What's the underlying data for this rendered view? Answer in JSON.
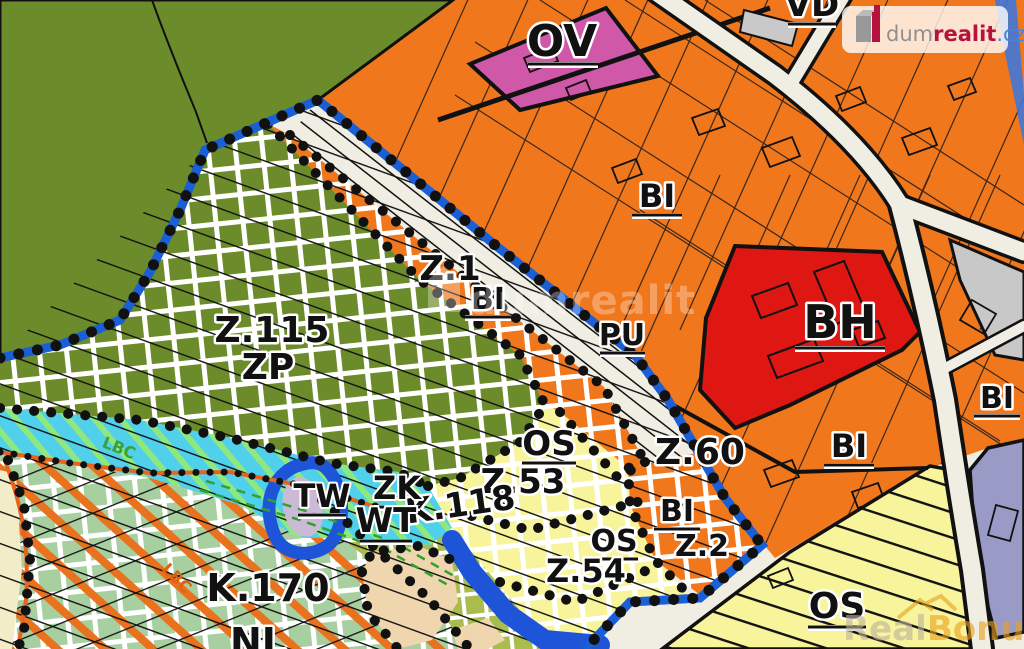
{
  "map": {
    "labels": {
      "ov": "OV",
      "vd": "VD",
      "bi": "BI",
      "bh": "BH",
      "pu": "PU",
      "z1": "Z.1",
      "z115": "Z.115",
      "zp": "ZP",
      "z60": "Z.60",
      "os": "OS",
      "z53": "Z.53",
      "z54": "Z.54",
      "k118": "K.118",
      "z2": "Z.2",
      "tw": "TW",
      "zk": "ZK",
      "wt": "WT",
      "k170": "K.170",
      "nl": "NL",
      "lbc": "LBC"
    },
    "colors": {
      "residential_bi": "#F1771D",
      "apartments_bh": "#DF1712",
      "civic_ov": "#CF58A8",
      "greenery_zp": "#6C8B2A",
      "landscape_green": "#A8CFA0",
      "olive_k118": "#A9BD4F",
      "recreation_os": "#F8F49B",
      "water_cyan": "#50D0EA",
      "river_blue": "#1E55D8",
      "boundary_blue": "#1A5FD6",
      "boundary_orange": "#E8641E",
      "lavender": "#9A9AC6",
      "gray": "#C8C8C8",
      "tan": "#EFD6AE",
      "road": "#F0EDE3"
    }
  },
  "watermarks": {
    "center": "dumrealit",
    "logo": {
      "dum": "dum",
      "realit": "realit",
      "tld": ".cz"
    },
    "realbonus": {
      "real": "Real",
      "bonus": "Bonus",
      "tld": ".cz"
    }
  }
}
